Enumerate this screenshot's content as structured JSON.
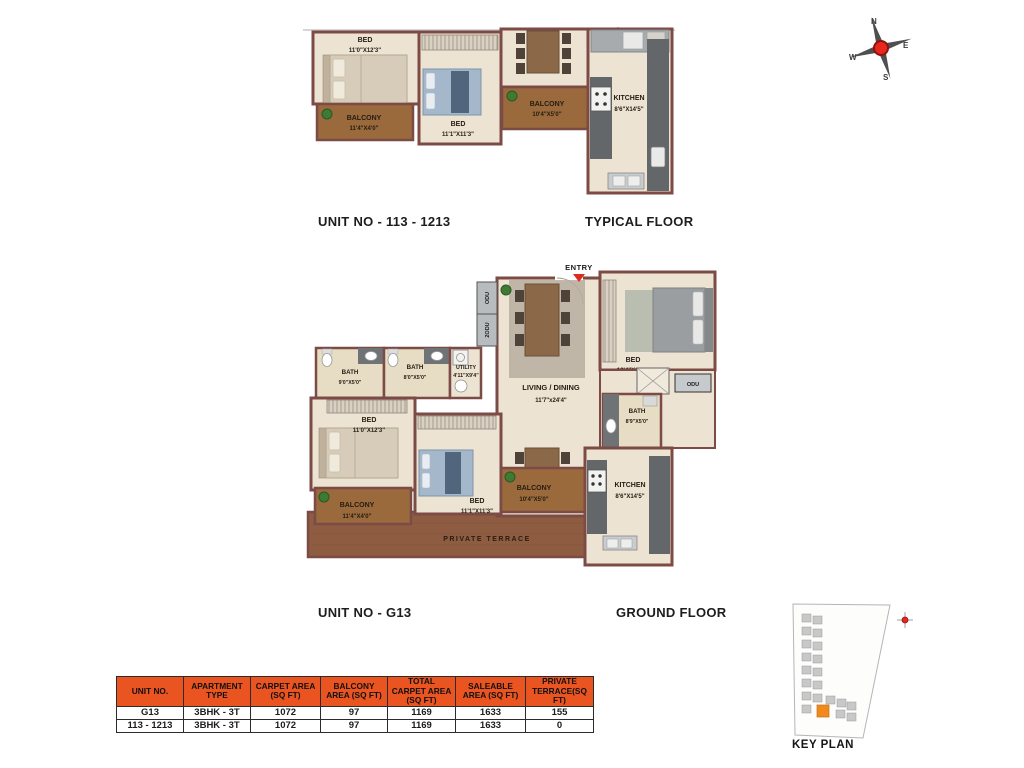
{
  "colors": {
    "wall": "#7D4B45",
    "floor": "#EDE3D2",
    "bath_floor": "#E7DCC4",
    "balcony": "#9A6A3C",
    "terrace": "#8E5C41",
    "counter_gray": "#63676A",
    "table_header_orange": "#E95420",
    "entry_red": "#DD2B1E",
    "compass_red": "#E8281E",
    "keyplan_highlight_orange": "#F08A1E"
  },
  "compass": {
    "n": "N",
    "e": "E",
    "s": "S",
    "w": "W"
  },
  "typical": {
    "title": "UNIT NO - 113 - 1213",
    "floor": "TYPICAL FLOOR",
    "bed1": {
      "name": "BED",
      "dims": "11'0\"X12'3\""
    },
    "balcony1": {
      "name": "BALCONY",
      "dims": "11'4\"X4'0\""
    },
    "bed2": {
      "name": "BED",
      "dims": "11'1\"X11'3\""
    },
    "balcony2": {
      "name": "BALCONY",
      "dims": "10'4\"X5'0\""
    },
    "kitchen": {
      "name": "KITCHEN",
      "dims": "8'6\"X14'5\""
    }
  },
  "ground": {
    "title": "UNIT NO - G13",
    "floor": "GROUND FLOOR",
    "entry": "ENTRY",
    "odu_a": "ODU",
    "odu_b": "2ODU",
    "odu_c": "ODU",
    "living": {
      "name": "LIVING / DINING",
      "dims": "11'7\"x24'4\""
    },
    "bed3": {
      "name": "BED",
      "dims": "13'4\"X11'3\""
    },
    "bath1": {
      "name": "BATH",
      "dims": "9'0\"X5'0\""
    },
    "bath2": {
      "name": "BATH",
      "dims": "8'0\"X5'0\""
    },
    "bath3": {
      "name": "BATH",
      "dims": "8'9\"X5'0\""
    },
    "utility": {
      "name": "UTILITY",
      "dims": "4'11\"X9'4\""
    },
    "bed1": {
      "name": "BED",
      "dims": "11'0\"X12'3\""
    },
    "balcony1": {
      "name": "BALCONY",
      "dims": "11'4\"X4'0\""
    },
    "bed2": {
      "name": "BED",
      "dims": "11'1\"X11'3\""
    },
    "balcony2": {
      "name": "BALCONY",
      "dims": "10'4\"X5'0\""
    },
    "kitchen": {
      "name": "KITCHEN",
      "dims": "8'6\"X14'5\""
    },
    "terrace": "PRIVATE TERRACE"
  },
  "key_plan": {
    "label": "KEY PLAN"
  },
  "area_table": {
    "headers": [
      "UNIT NO.",
      "APARTMENT TYPE",
      "CARPET AREA (SQ FT)",
      "BALCONY AREA (SQ FT)",
      "TOTAL CARPET AREA (SQ FT)",
      "SALEABLE AREA (SQ FT)",
      "PRIVATE TERRACE(SQ FT)"
    ],
    "rows": [
      [
        "G13",
        "3BHK - 3T",
        "1072",
        "97",
        "1169",
        "1633",
        "155"
      ],
      [
        "113 - 1213",
        "3BHK - 3T",
        "1072",
        "97",
        "1169",
        "1633",
        "0"
      ]
    ]
  }
}
